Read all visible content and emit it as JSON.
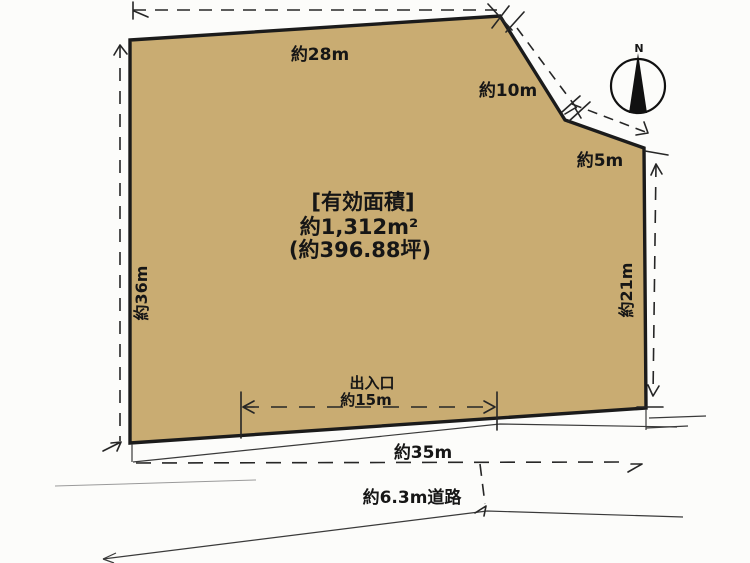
{
  "area_label": {
    "line1": "[有効面積]",
    "line2": "約1,312m²",
    "line3": "(約396.88坪)"
  },
  "dimensions": {
    "top": "約28m",
    "diagonal": "約10m",
    "upper_right": "約5m",
    "left": "約36m",
    "right": "約21m",
    "bottom": "約35m",
    "entrance_title": "出入口",
    "entrance_width": "約15m",
    "road": "約6.3m道路"
  },
  "compass": {
    "north": "N"
  },
  "colors": {
    "parcel_fill": "#c9ac72",
    "outline": "#1b1b1b",
    "background": "#fcfcfa"
  }
}
